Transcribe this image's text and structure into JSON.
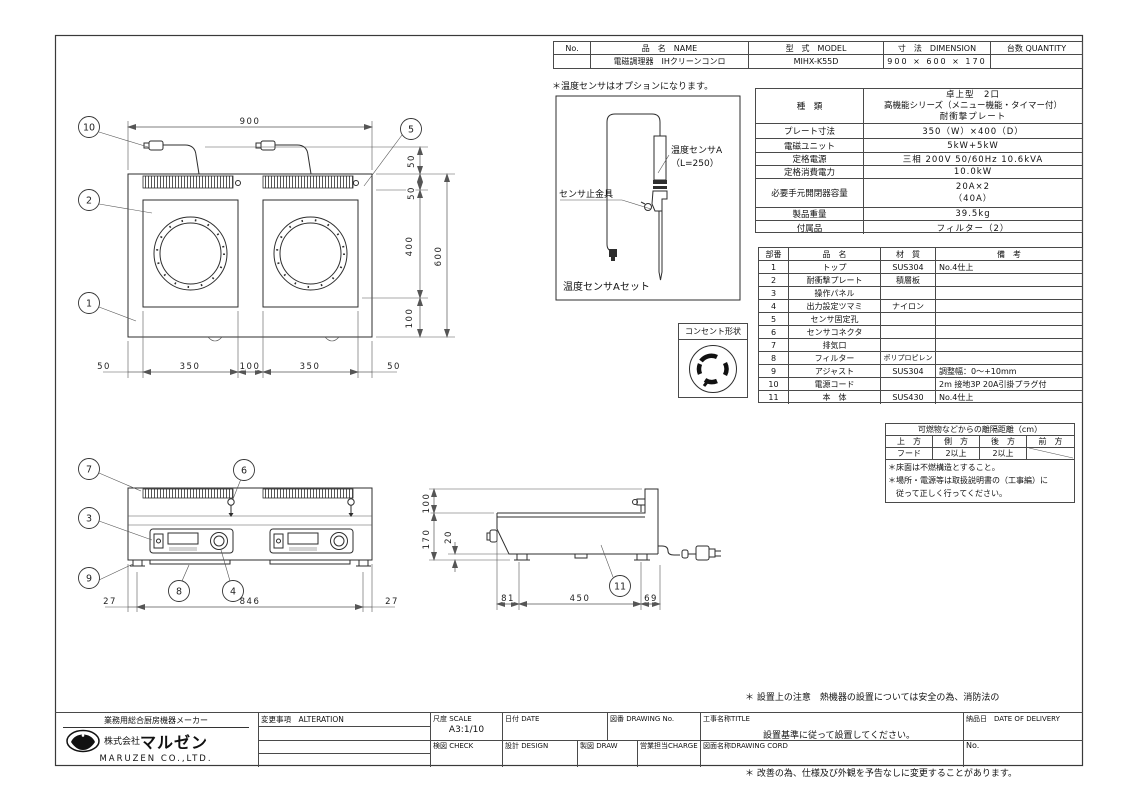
{
  "header_table": {
    "headers": {
      "no": "No.",
      "name": "品　名　NAME",
      "model": "型　式　MODEL",
      "dimension": "寸　法　DIMENSION",
      "quantity": "台数 QUANTITY"
    },
    "row": {
      "no": "",
      "name": "電磁調理器　IHクリーンコンロ",
      "model": "MIHX-K55D",
      "dimension": "900 × 600 × 170",
      "quantity": ""
    }
  },
  "spec_table": {
    "rows": [
      {
        "label": "種　類",
        "v1": "卓上型　2口",
        "v2": "高機能シリーズ（メニュー機能・タイマー付）",
        "v3": "耐衝撃プレート"
      },
      {
        "label": "プレート寸法",
        "value": "350（W）×400（D）"
      },
      {
        "label": "電磁ユニット",
        "value": "5kW+5kW"
      },
      {
        "label": "定格電源",
        "value": "三相 200V 50/60Hz 10.6kVA"
      },
      {
        "label": "定格消費電力",
        "value": "10.0kW"
      },
      {
        "label": "必要手元開閉器容量",
        "v1": "20A×2",
        "v2": "（40A）"
      },
      {
        "label": "製品重量",
        "value": "39.5kg"
      },
      {
        "label": "付属品",
        "value": "フィルター（2）"
      }
    ]
  },
  "parts_table": {
    "headers": {
      "no": "部番",
      "name": "品　名",
      "material": "材　質",
      "note": "備　考"
    },
    "rows": [
      {
        "no": "1",
        "name": "トップ",
        "material": "SUS304",
        "note": "No.4仕上"
      },
      {
        "no": "2",
        "name": "耐衝撃プレート",
        "material": "積層板",
        "note": ""
      },
      {
        "no": "3",
        "name": "操作パネル",
        "material": "",
        "note": ""
      },
      {
        "no": "4",
        "name": "出力設定ツマミ",
        "material": "ナイロン",
        "note": ""
      },
      {
        "no": "5",
        "name": "センサ固定孔",
        "material": "",
        "note": ""
      },
      {
        "no": "6",
        "name": "センサコネクタ",
        "material": "",
        "note": ""
      },
      {
        "no": "7",
        "name": "排気口",
        "material": "",
        "note": ""
      },
      {
        "no": "8",
        "name": "フィルター",
        "material": "ポリプロピレン",
        "note": ""
      },
      {
        "no": "9",
        "name": "アジャスト",
        "material": "SUS304",
        "note": "調整幅：0～+10mm"
      },
      {
        "no": "10",
        "name": "電源コード",
        "material": "",
        "note": "2m 接地3P 20A引掛プラグ付"
      },
      {
        "no": "11",
        "name": "本　体",
        "material": "SUS430",
        "note": "No.4仕上"
      }
    ]
  },
  "clearance_table": {
    "title": "可燃物などからの離隔距離（cm）",
    "headers": [
      "上　方",
      "側　方",
      "後　方",
      "前　方"
    ],
    "values": [
      "フード",
      "2以上",
      "2以上",
      ""
    ],
    "note1": "＊床面は不燃構造とすること。",
    "note2": "＊場所・電源等は取扱説明書の（工事編）に",
    "note3": "　従って正しく行ってください。"
  },
  "sensor_detail": {
    "note": "＊温度センサはオプションになります。",
    "sensor_label": "温度センサA",
    "sensor_length": "（L=250）",
    "clamp_label": "センサ止金具",
    "caption": "温度センサAセット"
  },
  "outlet": {
    "title": "コンセント形状"
  },
  "notes": {
    "line1": "＊ 設置上の注意　熱機器の設置については安全の為、消防法の",
    "line2": "　　設置基準に従って設置してください。",
    "line3": "＊ 改善の為、仕様及び外観を予告なしに変更することがあります。"
  },
  "title_block": {
    "tagline": "業務用総合厨房機器メーカー",
    "company_prefix": "株式会社",
    "company_name": "マルゼン",
    "company_en": "MARUZEN CO.,LTD.",
    "alteration": "変更事項　ALTERATION",
    "scale_label": "尺度 SCALE",
    "scale_value": "A3:1/10",
    "date_label": "日付 DATE",
    "drawing_no_label": "図番 DRAWING No.",
    "title_label": "工事名称TITLE",
    "delivery_label": "納品日　DATE OF DELIVERY",
    "check_label": "検図 CHECK",
    "design_label": "設計 DESIGN",
    "draw_label": "製図 DRAW",
    "charge_label": "営業担当CHARGE",
    "drawing_name_label": "図面名称DRAWING CORD",
    "no_label": "No."
  },
  "balloons": {
    "b1": "1",
    "b2": "2",
    "b3": "3",
    "b4": "4",
    "b5": "5",
    "b6": "6",
    "b7": "7",
    "b8": "8",
    "b9": "9",
    "b10": "10",
    "b11": "11"
  },
  "dims": {
    "tv_w": "900",
    "tv_s1": "50",
    "tv_s2": "50",
    "tv_s3": "400",
    "tv_s4": "100",
    "tv_total": "600",
    "tv_b1": "50",
    "tv_b2": "350",
    "tv_b3": "100",
    "tv_b4": "350",
    "tv_b5": "50",
    "fv_b1": "27",
    "fv_b2": "846",
    "fv_b3": "27",
    "sv_l1": "100",
    "sv_l2": "170",
    "sv_l3": "20",
    "sv_b1": "81",
    "sv_b2": "450",
    "sv_b3": "69"
  }
}
